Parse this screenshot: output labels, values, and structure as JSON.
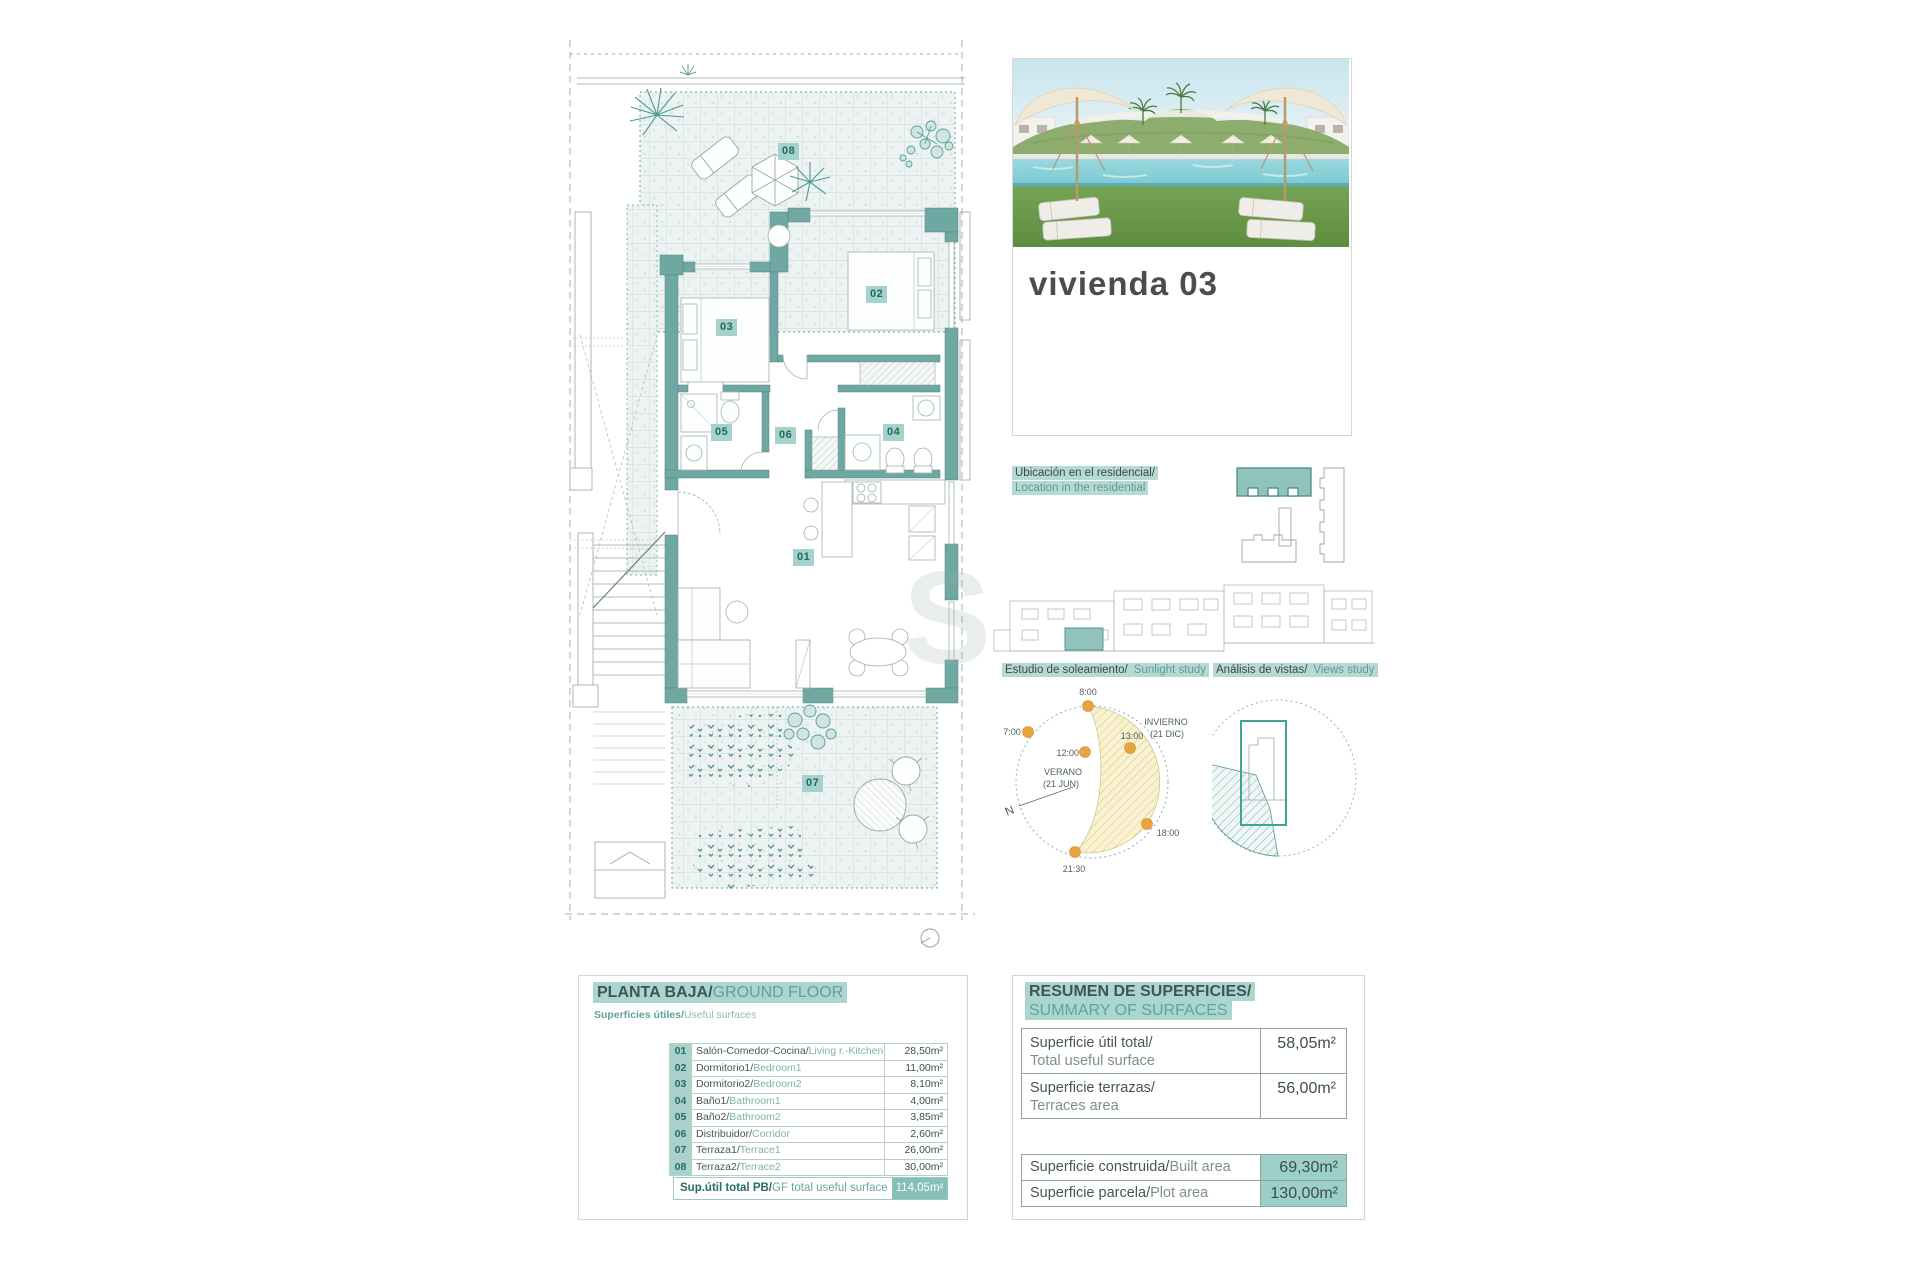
{
  "photo_card": {
    "title": "vivienda 03"
  },
  "location": {
    "line_es": "Ubicación en el residencial/",
    "line_en": "Location in the residential"
  },
  "studies": {
    "sunlight_es": "Estudio de soleamiento/",
    "sunlight_en": "Sunlight study",
    "views_es": "Análisis de vistas/",
    "views_en": "Views study",
    "sun_times": {
      "t8": "8:00",
      "t7": "7:00",
      "t13": "13:00",
      "t12": "12:00",
      "t18": "18:00",
      "t2130": "21:30"
    },
    "summer_label": "VERANO",
    "summer_date": "(21 JUN)",
    "winter_label": "INVIERNO",
    "winter_date": "(21 DIC)",
    "north_label": "N"
  },
  "plan": {
    "labels": {
      "l01": "01",
      "l02": "02",
      "l03": "03",
      "l04": "04",
      "l05": "05",
      "l06": "06",
      "l07": "07",
      "l08": "08"
    },
    "watermark": "S"
  },
  "ground_floor": {
    "title_es": "PLANTA BAJA/",
    "title_en": "GROUND FLOOR",
    "subtitle_es": "Superficies útiles/",
    "subtitle_en": "Useful surfaces",
    "rooms": [
      {
        "num": "01",
        "name_es": "Salón-Comedor-Cocina/",
        "name_en": "Living r.-Kitchen",
        "area": "28,50m²"
      },
      {
        "num": "02",
        "name_es": "Dormitorio1/",
        "name_en": "Bedroom1",
        "area": "11,00m²"
      },
      {
        "num": "03",
        "name_es": "Dormitorio2/",
        "name_en": "Bedroom2",
        "area": "8,10m²"
      },
      {
        "num": "04",
        "name_es": "Baño1/",
        "name_en": "Bathroom1",
        "area": "4,00m²"
      },
      {
        "num": "05",
        "name_es": "Baño2/",
        "name_en": "Bathroom2",
        "area": "3,85m²"
      },
      {
        "num": "06",
        "name_es": "Distribuidor/",
        "name_en": "Corridor",
        "area": "2,60m²"
      },
      {
        "num": "07",
        "name_es": "Terraza1/",
        "name_en": "Terrace1",
        "area": "26,00m²"
      },
      {
        "num": "08",
        "name_es": "Terraza2/",
        "name_en": "Terrace2",
        "area": "30,00m²"
      }
    ],
    "total_label_es": "Sup.útil total PB/",
    "total_label_en": "GF total useful surface",
    "total_value": "114,05m²"
  },
  "summary": {
    "title_es": "RESUMEN DE SUPERFICIES/",
    "title_en": "SUMMARY OF SURFACES",
    "rows": [
      {
        "label_es": "Superficie útil total/",
        "label_en": "Total useful surface",
        "value": "58,05m²"
      },
      {
        "label_es": "Superficie terrazas/",
        "label_en": "Terraces area",
        "value": "56,00m²"
      }
    ],
    "rows2": [
      {
        "label_es": "Superficie construida/",
        "label_en": "Built area",
        "value": "69,30m²"
      },
      {
        "label_es": "Superficie parcela/",
        "label_en": "Plot area",
        "value": "130,00m²"
      }
    ]
  },
  "colors": {
    "wall_teal": "#6fa8a2",
    "accent_teal": "#57948c",
    "highlight": "#abd6cf",
    "label_bg": "#a5d2ca",
    "label_text": "#1e6b63",
    "sun_dot": "#e8a43e",
    "sun_hatch": "#f5edc9"
  }
}
